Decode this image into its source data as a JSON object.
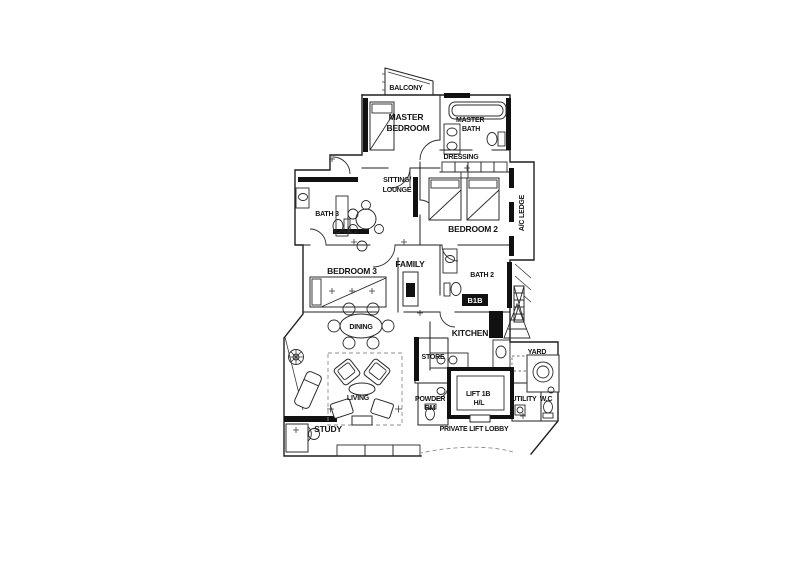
{
  "document": {
    "type": "apartment floor plan drawing"
  },
  "colors": {
    "ink": "#1f1f1f",
    "paper": "#ffffff"
  },
  "labels": {
    "balcony": "BALCONY",
    "master_bedroom": [
      "MASTER",
      "BEDROOM"
    ],
    "master_bath": [
      "MASTER",
      "BATH"
    ],
    "dressing": "DRESSING",
    "sitting_lounge": [
      "SITTING/",
      "LOUNGE"
    ],
    "bath3": "BATH 3",
    "bedroom2": "BEDROOM 2",
    "ac_ledge": "A/C LEDGE",
    "bedroom3": "BEDROOM 3",
    "family": "FAMILY",
    "bath2": "BATH 2",
    "db_badge": "B1B",
    "kitchen": "KITCHEN",
    "dining": "DINING",
    "store": "STORE",
    "yard": "YARD",
    "powder_rm": [
      "POWDER",
      "RM"
    ],
    "lift": [
      "LIFT 1B",
      "H/L"
    ],
    "utility": "UTILITY",
    "wc": "W.C",
    "private_lift_lobby": "PRIVATE LIFT LOBBY",
    "living": "LIVING",
    "study": "STUDY"
  }
}
